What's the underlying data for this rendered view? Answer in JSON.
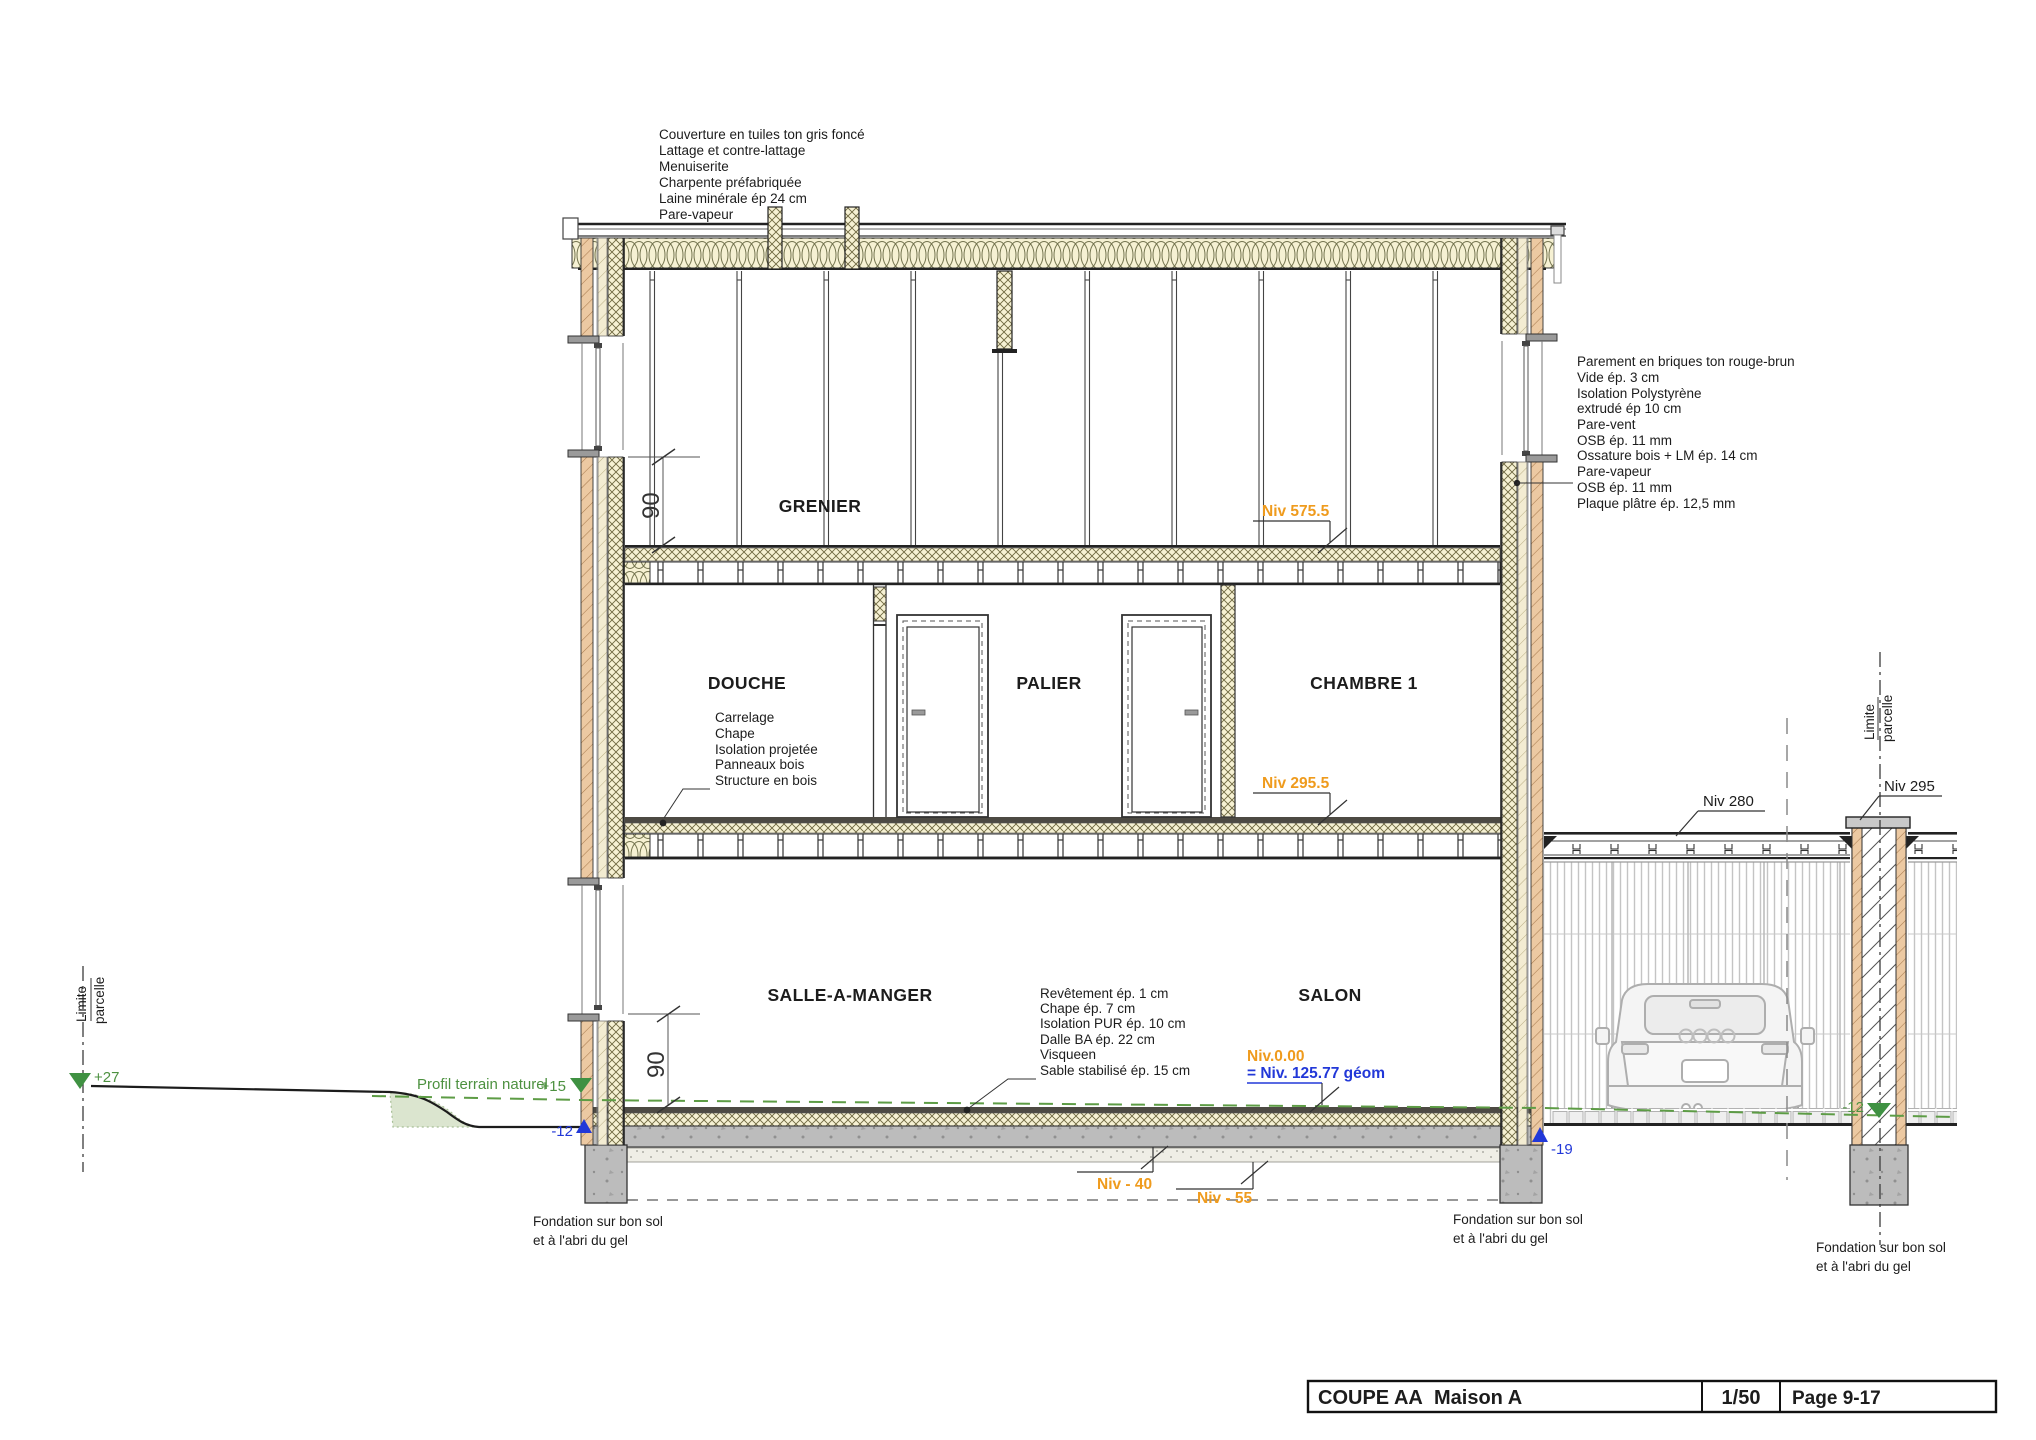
{
  "title_block": {
    "title": "COUPE AA",
    "variant": "Maison A",
    "scale": "1/50",
    "page": "Page 9-17"
  },
  "rooms": {
    "attic": "GRENIER",
    "shower": "DOUCHE",
    "landing": "PALIER",
    "bedroom": "CHAMBRE 1",
    "dining": "SALLE-A-MANGER",
    "living": "SALON"
  },
  "notes": {
    "roof": [
      "Couverture en tuiles ton gris foncé",
      "Lattage et contre-lattage",
      "Menuiserite",
      "Charpente préfabriquée",
      "Laine minérale ép 24 cm",
      "Pare-vapeur"
    ],
    "wall": [
      "Parement en briques ton rouge-brun",
      "Vide ép. 3 cm",
      "Isolation Polystyrène",
      "extrudé ép 10 cm",
      "Pare-vent",
      "OSB ép. 11 mm",
      "Ossature bois + LM ép. 14 cm",
      "Pare-vapeur",
      "OSB ép. 11 mm",
      "Plaque plâtre ép. 12,5 mm"
    ],
    "floor_upper": [
      "Carrelage",
      "Chape",
      "Isolation projetée",
      "Panneaux bois",
      "Structure en bois"
    ],
    "slab": [
      "Revêtement ép. 1 cm",
      "Chape ép. 7 cm",
      "Isolation PUR ép. 10 cm",
      "Dalle BA ép. 22 cm",
      "Visqueen",
      "Sable stabilisé ép. 15 cm"
    ],
    "foundation_line1": "Fondation sur bon sol",
    "foundation_line2": "et à l'abri du gel"
  },
  "levels": {
    "attic_floor": "Niv 575.5",
    "upper_floor": "Niv 295.5",
    "ground": "Niv.0.00",
    "ground_geo": "= Niv. 125.77 géom",
    "slab_bottom": "Niv - 40",
    "sand_bottom": "Niv - 55",
    "carport_roof": "Niv 280",
    "pillar_top": "Niv 295"
  },
  "markers": {
    "boundary_left": "+27",
    "terrain_left": "+15",
    "excav_left": "-12",
    "excav_right": "-19",
    "terrain_right": "-12"
  },
  "labels": {
    "terrain_profile": "Profil terrain naturel",
    "boundary_l1": "Limite",
    "boundary_l2": "parcelle",
    "dim_attic": "90",
    "dim_ground": "90"
  },
  "colors": {
    "accent_orange": "#ef9b1d",
    "level_blue": "#2238d8",
    "terrain_green": "#4d9140",
    "brick": "#ecc9a2",
    "insulation": "#f6f1d3",
    "concrete": "#bcbcbc"
  }
}
